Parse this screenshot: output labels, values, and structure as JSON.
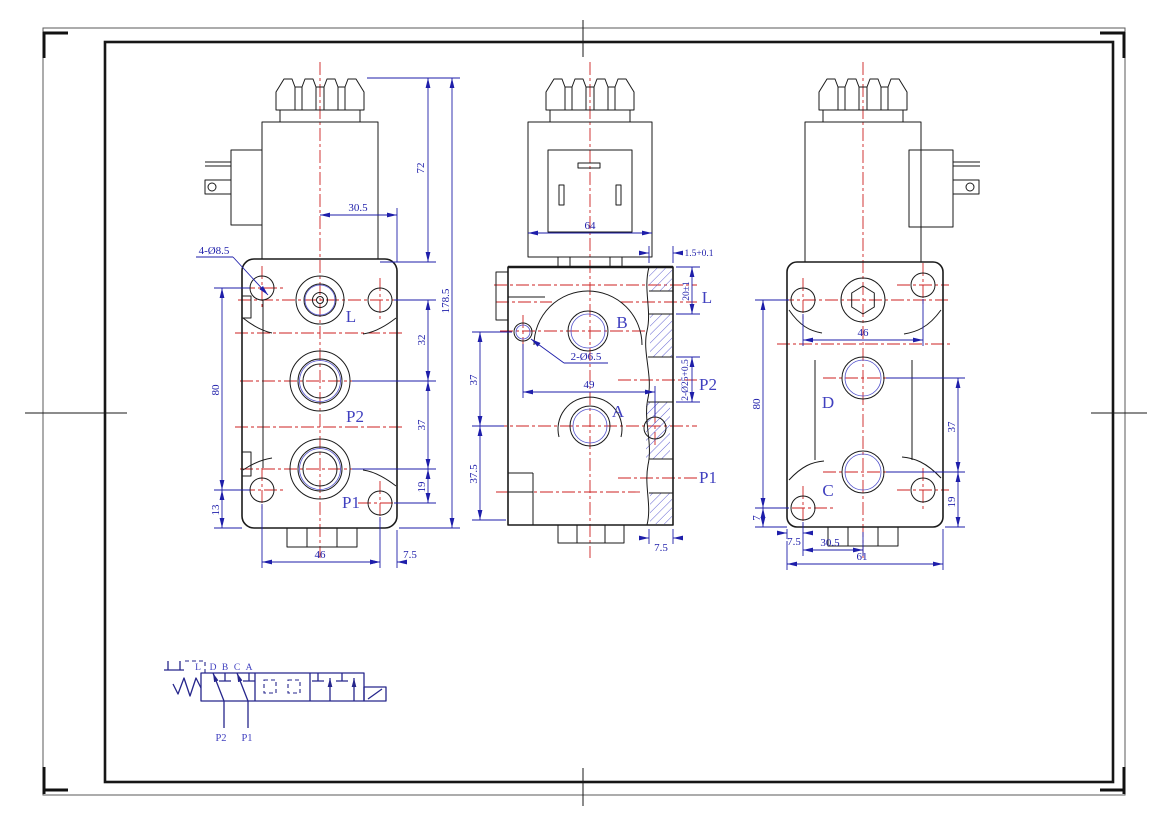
{
  "colors": {
    "outline": "#1a1a1a",
    "dimension_blue": "#1e1eaa",
    "label_blue": "#4040bf",
    "centerline_red": "#cc2222",
    "hatch_blue": "#5050cc",
    "schematic_navy": "#26268c"
  },
  "front_view": {
    "ports": {
      "l": "L",
      "p2": "P2",
      "p1": "P1"
    },
    "dims": {
      "coil_height": "72",
      "coil_offset": "30.5",
      "overall_height": "178.5",
      "span_l_p2": "32",
      "span_p2_p1": "37",
      "span_p1_base": "19",
      "hole_span": "80",
      "base_offset": "13",
      "hole_width": "46",
      "edge_offset": "7.5",
      "corner_holes": "4-Ø8.5"
    }
  },
  "section_view": {
    "ports": {
      "b": "B",
      "a": "A",
      "l": "L",
      "p2": "P2",
      "p1": "P1"
    },
    "dims": {
      "coil_width": "64",
      "spigot": "1.5+0.1",
      "spigot_depth": "20±1",
      "pilot_holes": "2-Ø6.5",
      "hole_pitch": "49",
      "span_upper": "37",
      "span_lower": "37.5",
      "port_bore": "2-Ø25+0.5",
      "edge_offset": "7.5"
    }
  },
  "rear_view": {
    "ports": {
      "d": "D",
      "c": "C"
    },
    "dims": {
      "hole_width": "46",
      "span_d_c": "37",
      "span_c_base": "19",
      "hole_span": "80",
      "foot": "7",
      "edge_offset": "7.5",
      "center_offset": "30.5",
      "width": "61"
    }
  },
  "schematic": {
    "drain": "L",
    "ports": [
      "D",
      "B",
      "C",
      "A"
    ],
    "supply": [
      "P2",
      "P1"
    ]
  }
}
